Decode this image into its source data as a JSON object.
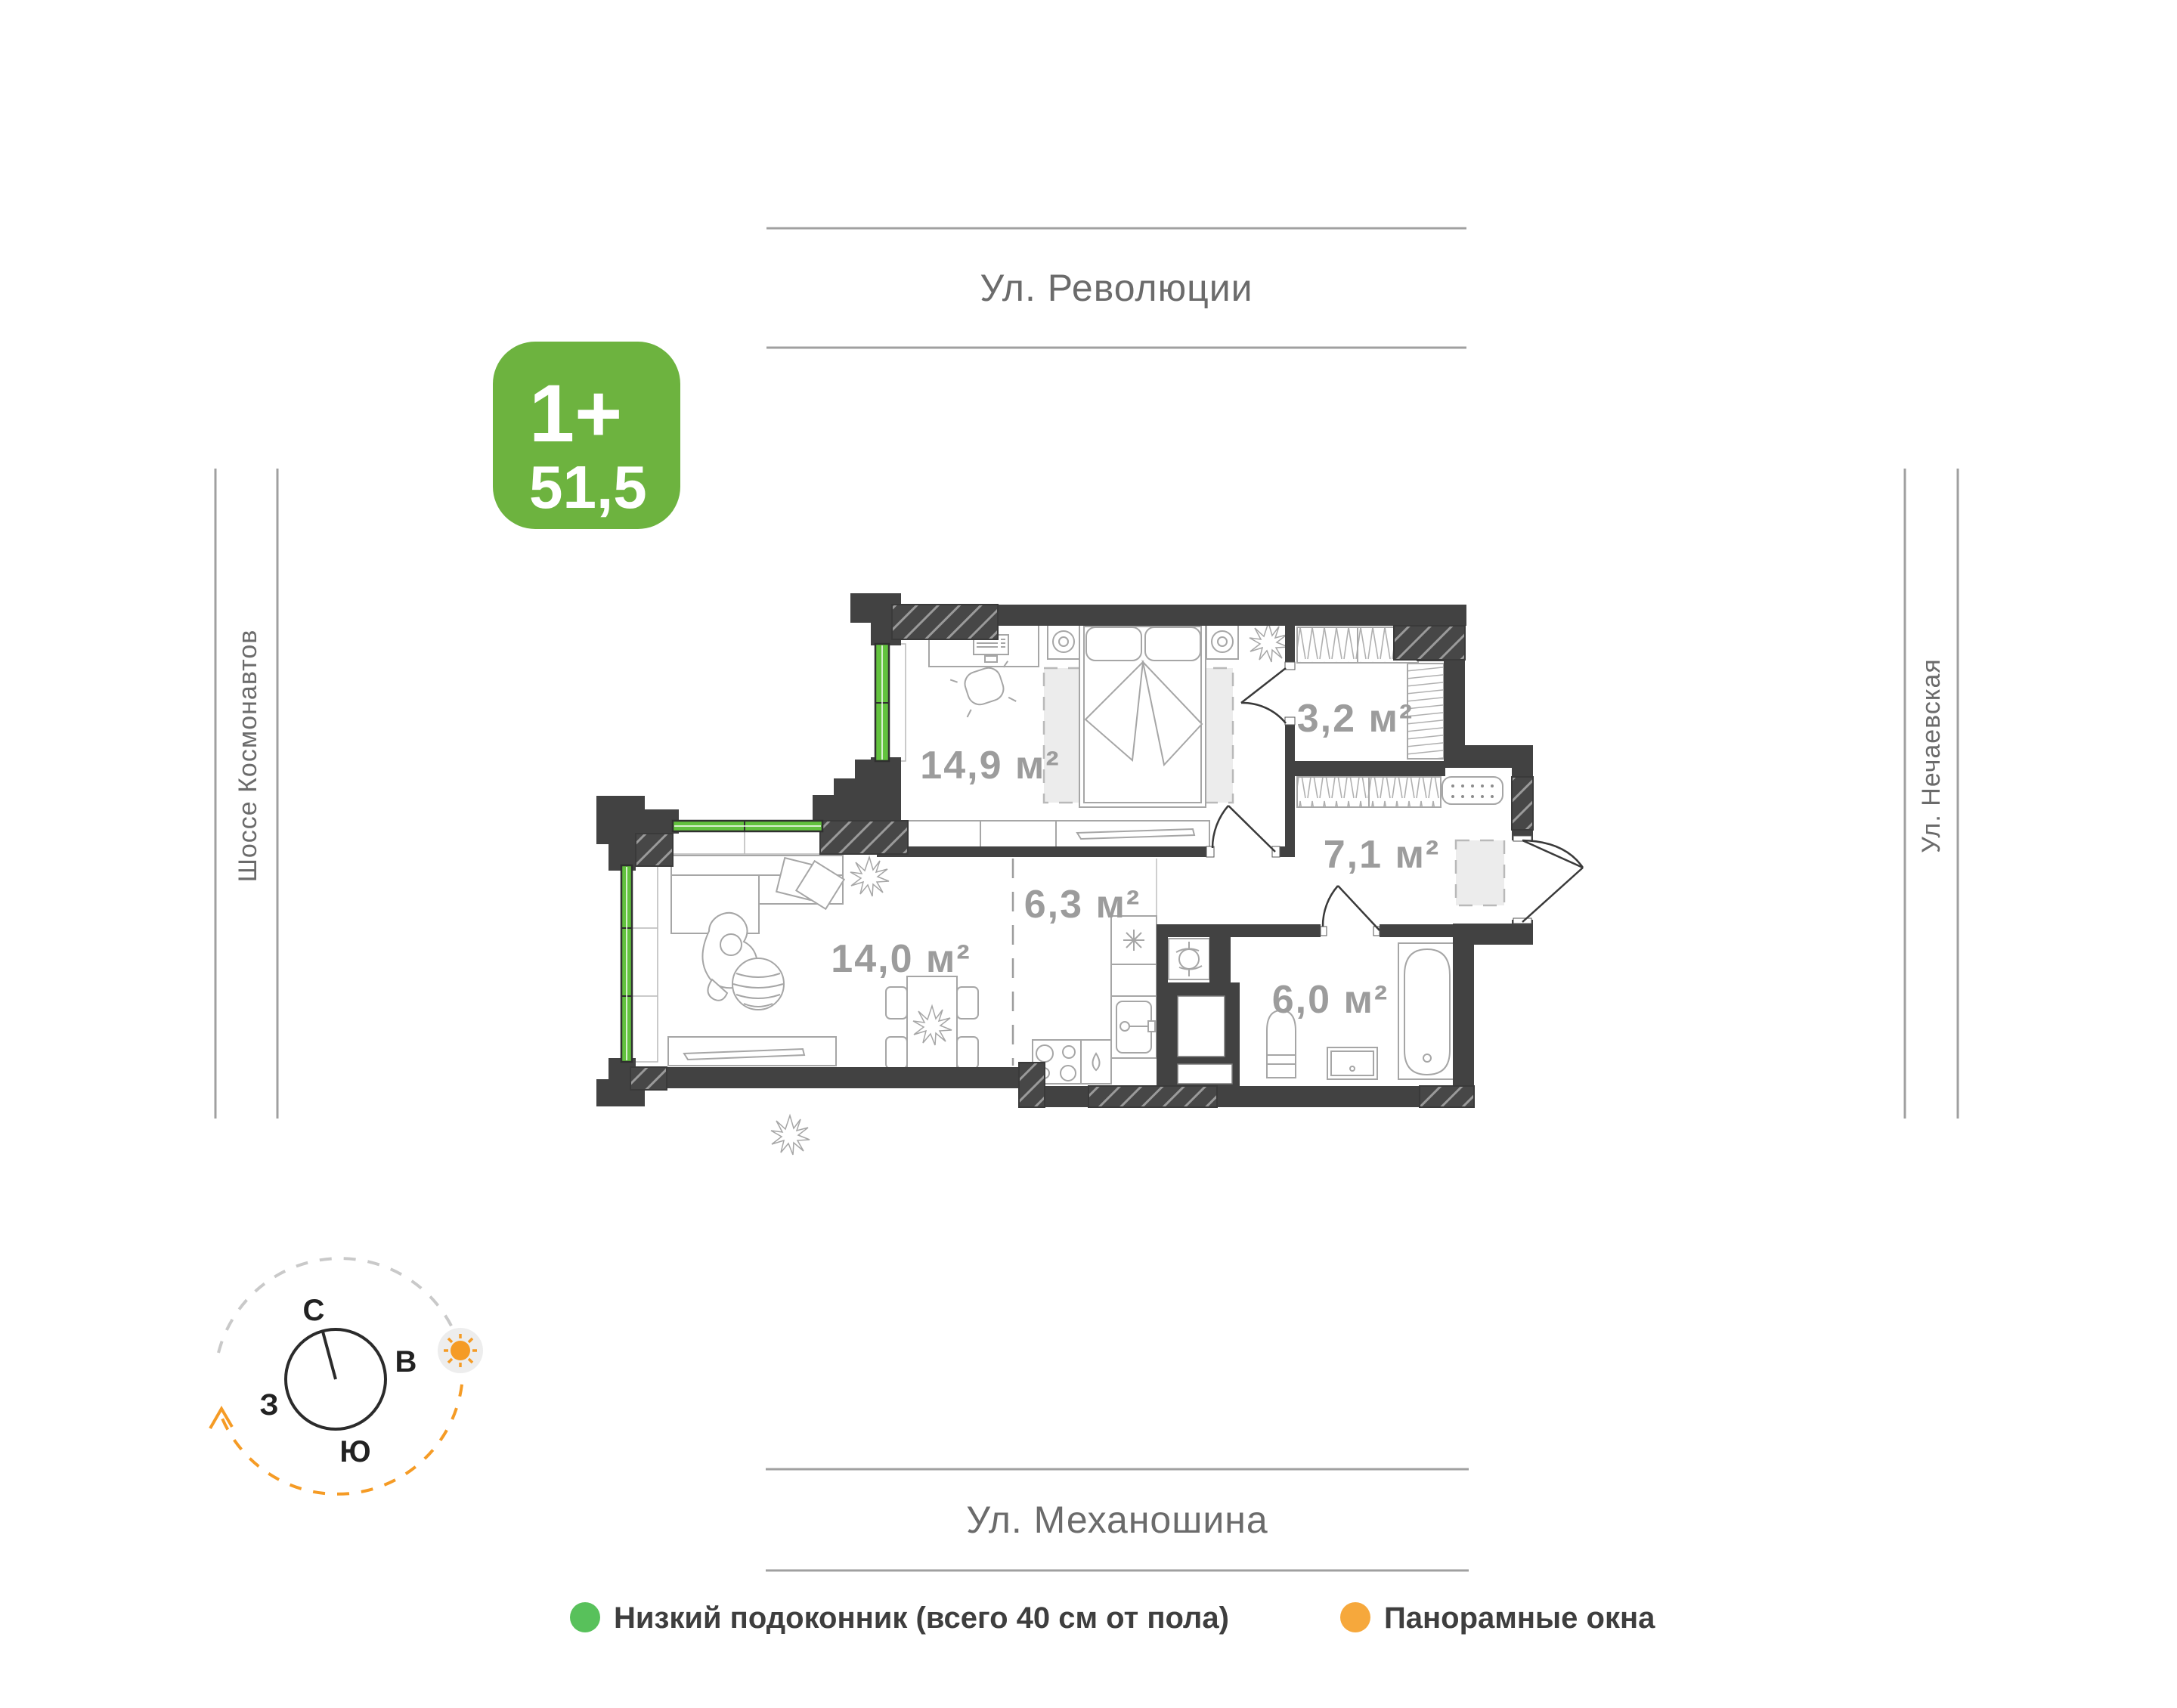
{
  "badge": {
    "type_label": "1+",
    "area_value": "51,5",
    "bg_color": "#6db33f"
  },
  "streets": {
    "top": "Ул. Революции",
    "bottom": "Ул. Механошина",
    "left": "Шоссе Космонавтов",
    "right": "Ул. Нечаевская"
  },
  "plan": {
    "wall_color": "#424242",
    "window_color": "#62c23e",
    "rooms": [
      {
        "id": "bedroom",
        "area_label": "14,9 м²"
      },
      {
        "id": "wardrobe",
        "area_label": "3,2 м²"
      },
      {
        "id": "hallway",
        "area_label": "7,1 м²"
      },
      {
        "id": "kitchen",
        "area_label": "6,3 м²"
      },
      {
        "id": "living",
        "area_label": "14,0 м²"
      },
      {
        "id": "bathroom",
        "area_label": "6,0 м²"
      }
    ]
  },
  "compass": {
    "north": "С",
    "east": "В",
    "south": "Ю",
    "west": "З",
    "accent_color": "#f59b25"
  },
  "legend": [
    {
      "label": "Низкий подоконник (всего 40 см от пола)",
      "dot_color": "#58c15b"
    },
    {
      "label": "Панорамные окна",
      "dot_color": "#f6a83c"
    }
  ]
}
